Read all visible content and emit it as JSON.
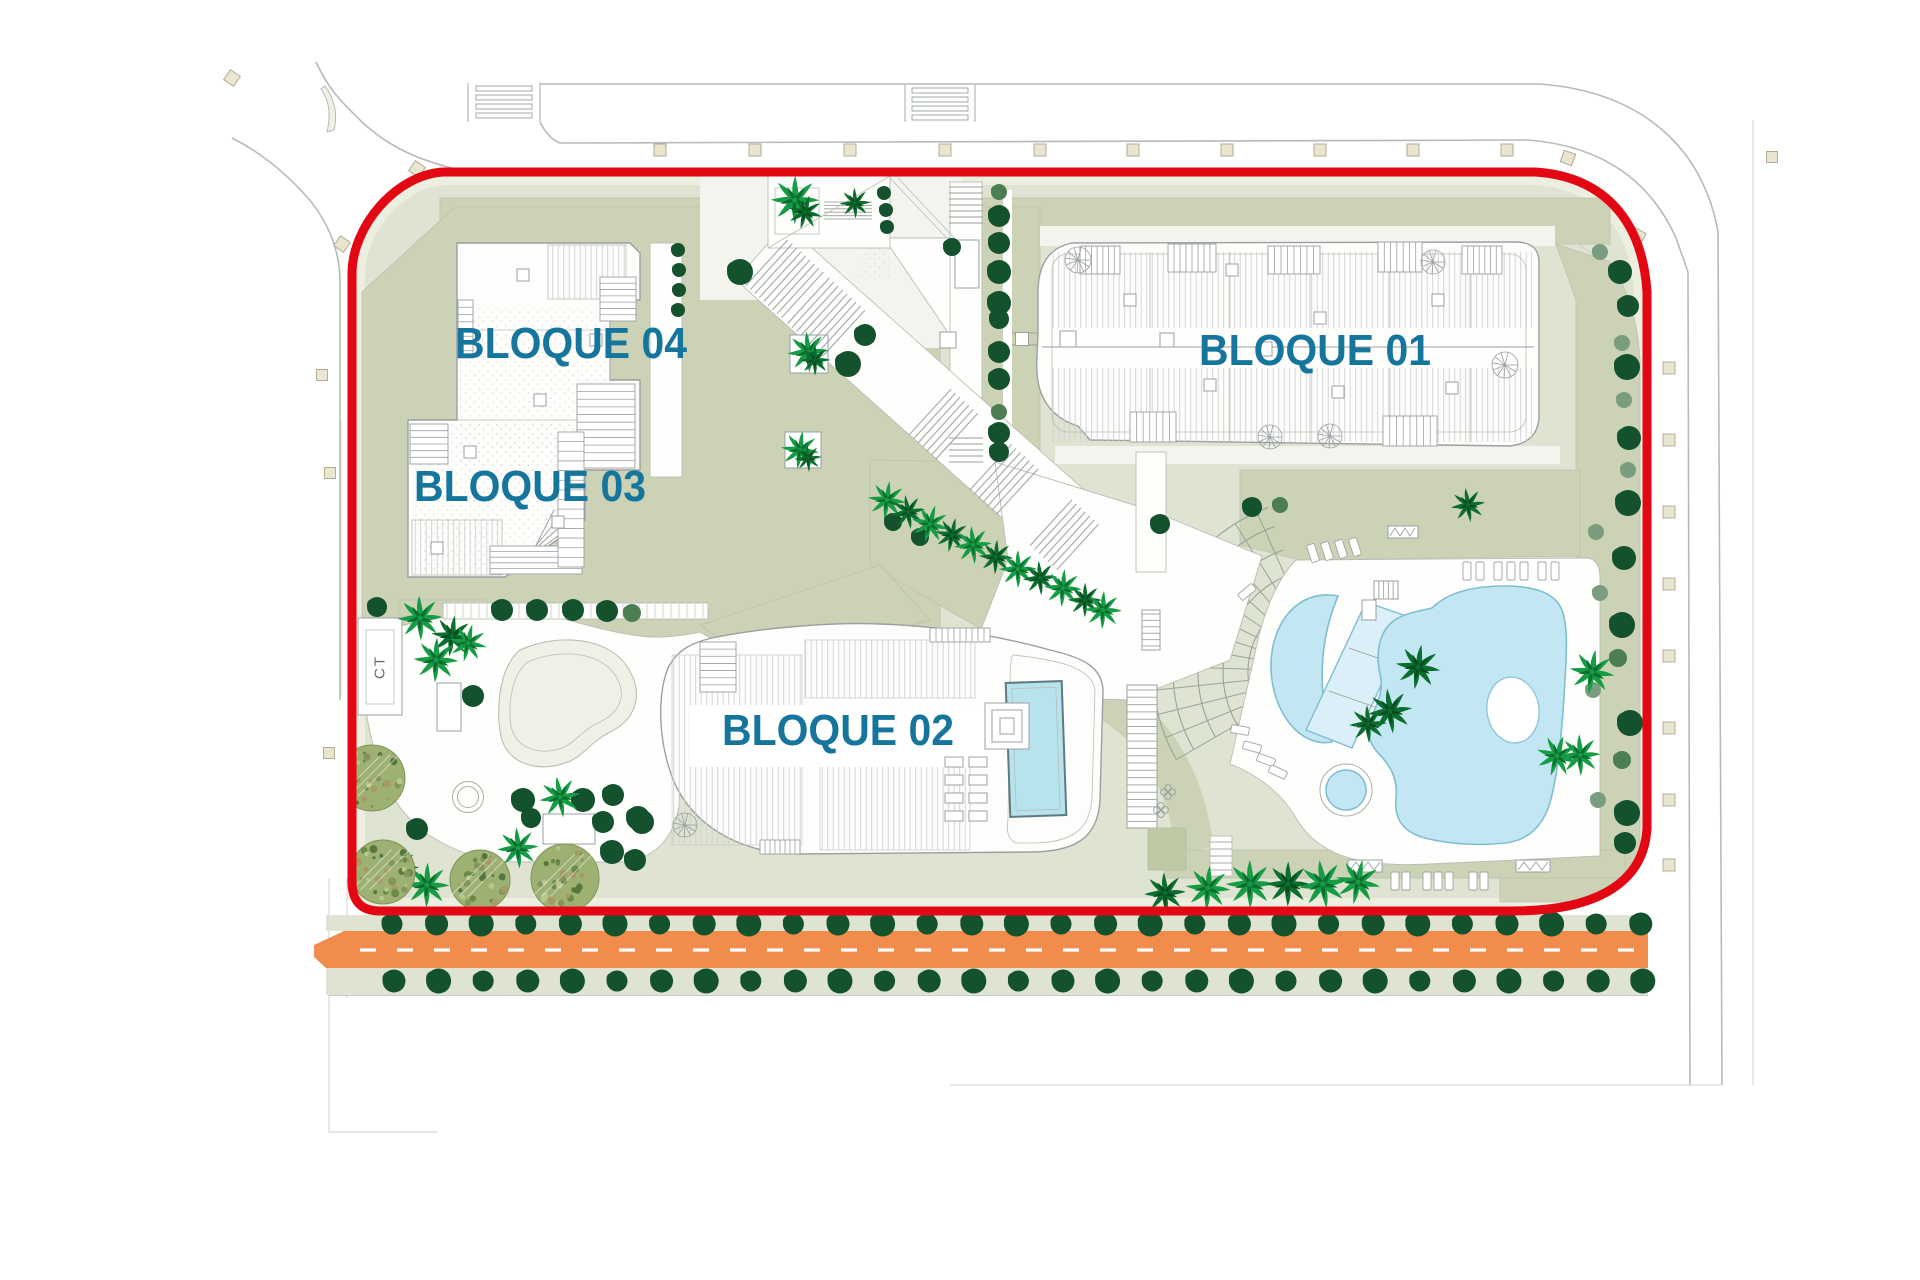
{
  "plan": {
    "block_labels": {
      "b01": "BLOQUE 01",
      "b02": "BLOQUE 02",
      "b03": "BLOQUE 03",
      "b04": "BLOQUE 04"
    },
    "utility_label": "CT"
  },
  "colors": {
    "boundary_red": "#e30613",
    "label_blue": "#15759c",
    "road_orange": "#f18c4d",
    "garden_sage": "#dfe3d1",
    "garden_sage_light": "#ecefe0",
    "garden_olive": "#cbd2b5",
    "tree_dark": "#14512d",
    "tree_medium": "#4d7d53",
    "tree_light": "#7a9c7f",
    "palm_bright": "#169c44",
    "palm_dark": "#0b6e2f",
    "mottle_base": "#9db173",
    "pool_water": "#c2e7f2",
    "pool_edge": "#7fbdd2",
    "rooftop_pool": "#b7e3ec",
    "street_line": "#b9b9b9",
    "marker_beige": "#e9e5d0"
  }
}
